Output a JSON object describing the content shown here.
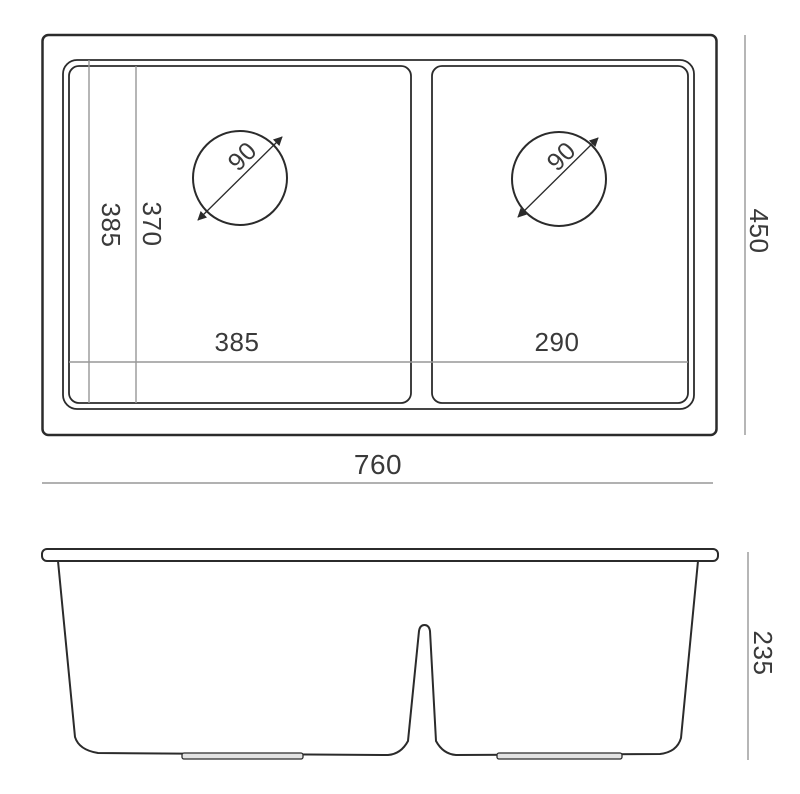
{
  "drawing": {
    "type": "sink-technical-drawing",
    "colors": {
      "outline": "#2b2b2b",
      "dimension_line": "#979797",
      "text": "#3a3a3a",
      "foot_fill": "#e3e3e3",
      "background": "#ffffff"
    },
    "top_view": {
      "dim_overall_width": "760",
      "dim_overall_depth": "450",
      "dim_bowl_left_width": "385",
      "dim_bowl_right_width": "290",
      "dim_bowl_depth_outer": "385",
      "dim_bowl_depth_inner": "370",
      "dim_drain_left_diameter": "90",
      "dim_drain_right_diameter": "90"
    },
    "front_view": {
      "dim_height": "235"
    }
  }
}
